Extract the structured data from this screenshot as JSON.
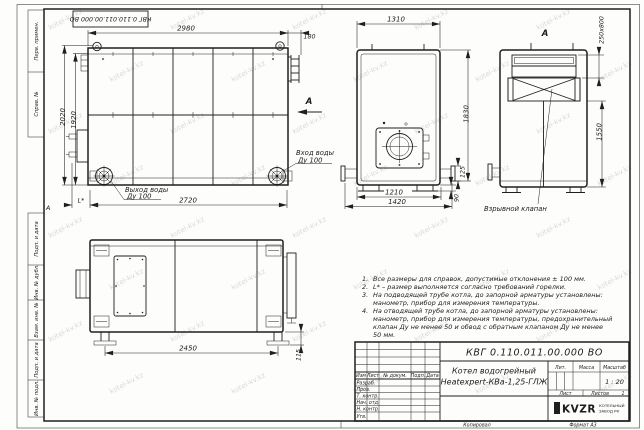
{
  "sheet": {
    "stamp_doc_number": "КВГ 0.110.011.00.000 ВО",
    "zone_letter": "А",
    "copied_label": "Копировал",
    "format_label": "Формат А3"
  },
  "margin": {
    "col1": "Перв. примен.",
    "col2": "Справ. №",
    "col3": "Подп. и дата",
    "col4": "Инв. № дубл.",
    "col5": "Взам. инв. №",
    "col6": "Подп. и дата",
    "col7": "Инв. № подл."
  },
  "views": {
    "side": {
      "dims": {
        "top": "2980",
        "ext": "180",
        "h_outer": "2020",
        "h_inner": "1920",
        "bottom": "2720",
        "l": "L*"
      },
      "labels": {
        "outlet1": "Выход воды",
        "outlet2": "Ду 100",
        "inlet1": "Вход воды",
        "inlet2": "Ду 100",
        "arrow": "А"
      }
    },
    "front": {
      "dims": {
        "top": "1310",
        "height": "1830",
        "d125": "125",
        "d90": "90",
        "b1": "1210",
        "b2": "1420"
      }
    },
    "a": {
      "label": "А",
      "dims": {
        "opening": "250x800",
        "height": "1550"
      },
      "callout": "Взрывной клапан"
    },
    "rear": {
      "dims": {
        "bottom": "2450",
        "right": "115"
      }
    }
  },
  "notes": {
    "rows": [
      {
        "n": "1.",
        "t": "Все размеры для справок, допустимые отклонения ± 100 мм."
      },
      {
        "n": "2.",
        "t": "L* – размер выполняется согласно требований горелки."
      },
      {
        "n": "3.",
        "t": "На подводящей трубе котла, до запорной арматуры установлены:"
      },
      {
        "n": "",
        "t": "манометр, прибор для измерения температуры."
      },
      {
        "n": "4.",
        "t": "На отводящей трубе котла, до запорной арматуры установлены:"
      },
      {
        "n": "",
        "t": "манометр, прибор для измерения температуры, предохранительный"
      },
      {
        "n": "",
        "t": "клапан Ду не менее 50 и обвод с обратным клапаном Ду не менее"
      },
      {
        "n": "",
        "t": "50 мм."
      }
    ]
  },
  "title_block": {
    "doc_number": "КВГ 0.110.011.00.000 ВО",
    "product_name_1": "Котел водогрейный",
    "product_name_2": "Heatexpert-КВа-1,25-ГЛЖ",
    "headers": {
      "izm": "Изм",
      "list": "Лист",
      "doc": "№ докум.",
      "sign": "Подп.",
      "date": "Дата",
      "lit": "Лит.",
      "mass": "Масса",
      "scale": "Масштаб",
      "sheet": "Лист",
      "sheets": "Листов"
    },
    "rows": [
      "Разраб.",
      "Пров.",
      "Т. контр.",
      "Нач. отд.",
      "Н. контр.",
      "Утв."
    ],
    "scale_value": "1 : 20",
    "sheets_value": "1",
    "logo_text": "KVZR",
    "org_line1": "КОТЕЛЬНЫЙ",
    "org_line2": "ЗАВОД РК"
  },
  "watermark": {
    "text": "kotel-kv.kz"
  },
  "colors": {
    "line": "#1f1f1f",
    "sheet": "#fdfdfc",
    "watermark": "#c3bcb1"
  }
}
